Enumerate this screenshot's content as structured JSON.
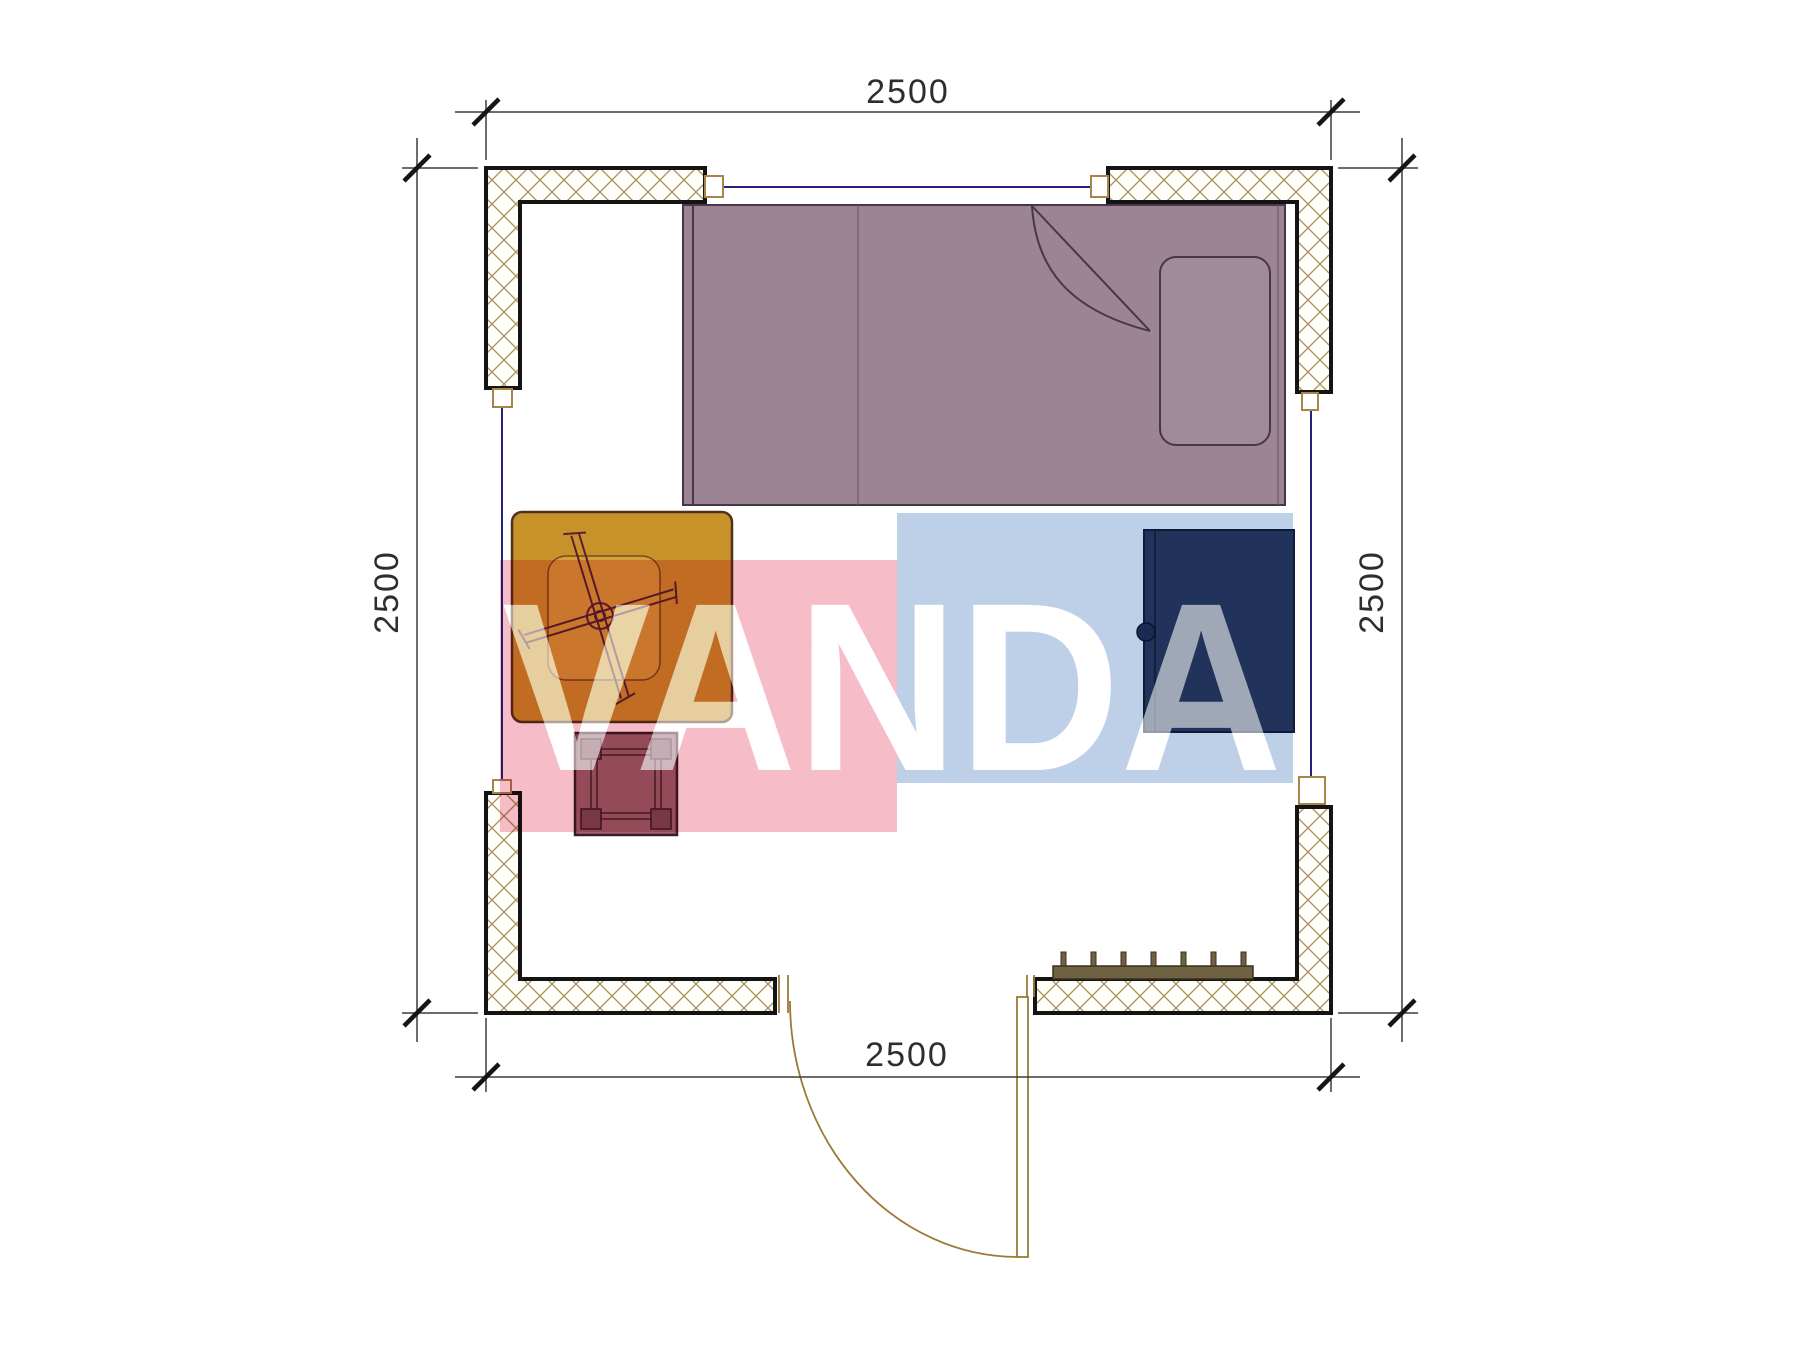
{
  "page": {
    "title": "Floor plan 2500 x 2500",
    "background": "#ffffff"
  },
  "dimensions": {
    "top": "2500",
    "bottom": "2500",
    "left": "2500",
    "right": "2500"
  },
  "watermark": {
    "text": "VANDA",
    "letters_color": "#ffffff",
    "pink_block_color": "#f5b6c2",
    "blue_block_color": "#b6cbe4"
  },
  "colors": {
    "wall_outline": "#141414",
    "wall_hatch": "#ac9668",
    "window_line": "#23237e",
    "frame_line": "#9a7a35",
    "dim_line": "#3c3c3c",
    "dim_text": "#2e2e2e",
    "bed_fill": "#9c8494",
    "bed_line": "#473747",
    "table_fill": "#c8922b",
    "table_inner_fill": "#d2a139",
    "stool_fill": "#9a6370",
    "stool_leg_fill": "#7e4a57",
    "cabinet_fill": "#2c3e63",
    "radiator_fill": "#6f6242"
  }
}
